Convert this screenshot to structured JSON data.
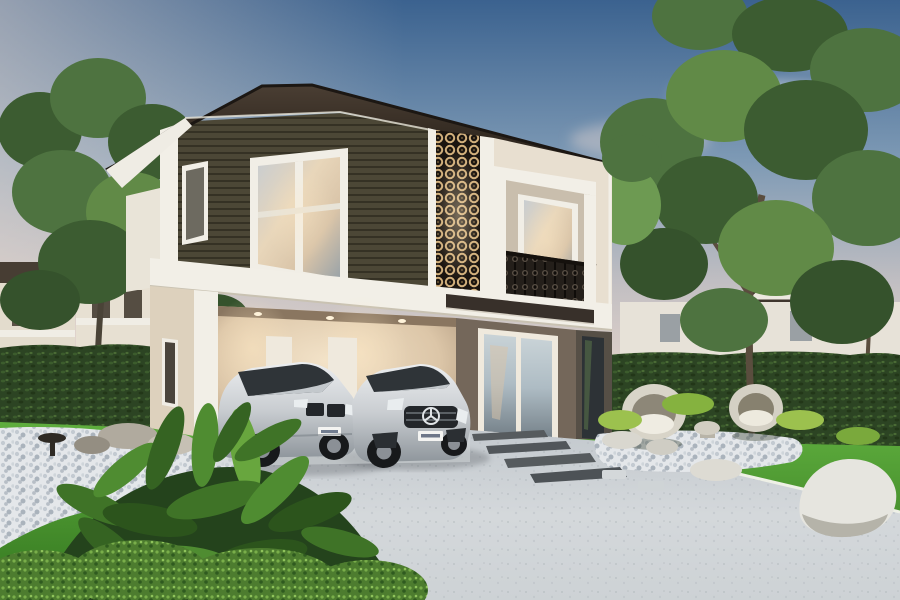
{
  "scene": {
    "type": "architectural-render",
    "description": "Exterior rendering of a modern two-story house at dusk: dark hip roof, olive-brown siding upstairs, decorative lattice screen, balcony with ornamental railing, open carport with two silver cars, grey driveway, bright lawn, pebble beds, rocks, round garden chairs, hedges and neighbouring houses behind trees",
    "objects": {
      "sky": "dusk sky with pink clouds",
      "main_house": "two-story modern house",
      "roof": "dark brown hip roof with wide eaves",
      "upper_siding": "olive-brown horizontal siding with white framed window",
      "lattice_screen": "dark decorative lattice panel, warm backlit",
      "balcony": "white framed balcony with dark ornamental railing",
      "carport": "open carport with warm downlights and two back doors",
      "entrance": "glass double entry door under dark canopy",
      "car_left": "silver sedan",
      "car_right": "silver hatchback with star emblem",
      "driveway": "light grey concrete driveway",
      "lawn": "bright green lawn",
      "hedges": "trimmed dark green hedges",
      "pebble_beds": "white pebble beds",
      "rocks": "white garden boulders",
      "garden_chairs": "two round rattan garden chairs with small table",
      "tropical_plants": "foreground tropical plants and shrubs",
      "neighbor_houses": "neighbouring two-story houses behind hedge",
      "trees": "large green trees left and right"
    },
    "license_plates": "present on both cars, illegible at this resolution"
  },
  "colors": {
    "sky_top": "#3b628f",
    "sky_mid": "#7e9ab5",
    "sky_horizon": "#ecd9cd",
    "cloud_pink": "#f0ddd3",
    "roof_dark": "#332a22",
    "roof_edge": "#1c1713",
    "soffit": "#efece4",
    "siding": "#56513f",
    "siding_line": "#3a3629",
    "trim_white": "#f2efe7",
    "wall_cream": "#e8dfd0",
    "wall_cream_dark": "#ddd1bd",
    "wall_light": "#e9e4d8",
    "lattice_bg": "#1b1510",
    "lattice_glow": "#d2b07c",
    "railing_dark": "#241f1a",
    "canopy_dark": "#38302a",
    "entrance_wall": "#74675a",
    "shadow_wall": "#564f46",
    "door_white": "#efe9dd",
    "step_grey": "#d8d3c9",
    "glass_warm": "#d9c4a8",
    "glass_cool": "#aebcc4",
    "car_silver": "#dadde0",
    "car_silver_dark": "#8f969c",
    "car_glass": "#2f3438",
    "plate_white": "#f4f4f2",
    "driveway": "#ced3d7",
    "grass_light": "#5fae3e",
    "grass_dark": "#33761f",
    "hedge": "#2c4423",
    "pebble": "#e4e7ea",
    "rock_white": "#e6e5df",
    "tree_green": "#4e7340",
    "plant_dark": "#24431c"
  }
}
